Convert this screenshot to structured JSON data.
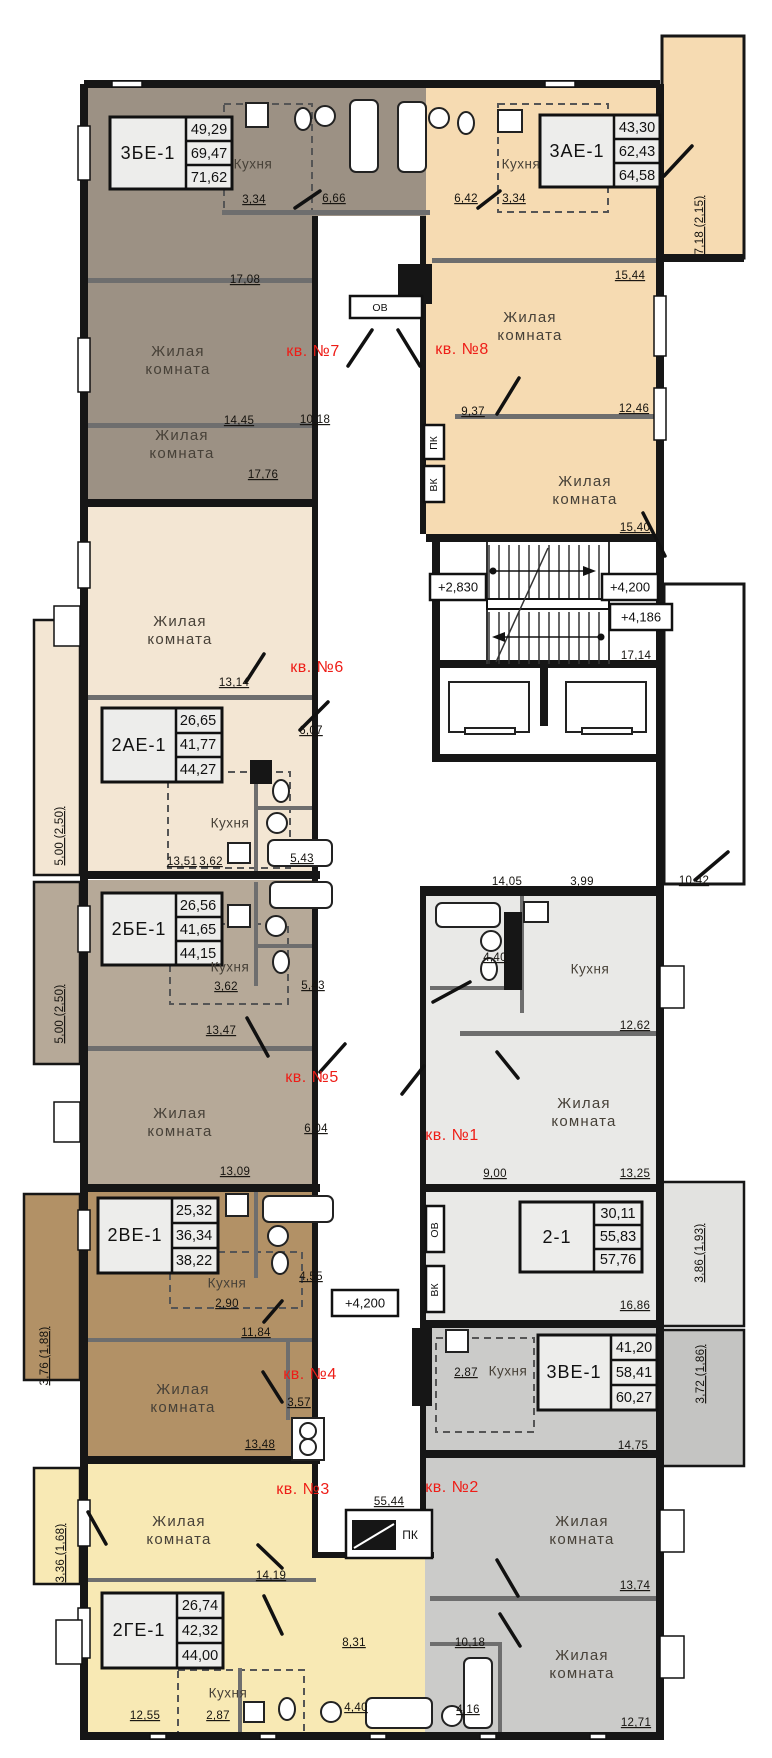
{
  "labels": {
    "living1": "Жилая",
    "living2": "комната",
    "kitchen": "Кухня",
    "ov": "ОВ",
    "pk": "ПК",
    "vk": "ВК"
  },
  "apartments": [
    {
      "flat": "кв. №1",
      "unit": "2-1",
      "areas": [
        "30,11",
        "55,83",
        "57,76"
      ]
    },
    {
      "flat": "кв. №2",
      "unit": "3ВЕ-1",
      "areas": [
        "41,20",
        "58,41",
        "60,27"
      ]
    },
    {
      "flat": "кв. №3",
      "unit": "2ГЕ-1",
      "areas": [
        "26,74",
        "42,32",
        "44,00"
      ]
    },
    {
      "flat": "кв. №4",
      "unit": "2ВЕ-1",
      "areas": [
        "25,32",
        "36,34",
        "38,22"
      ]
    },
    {
      "flat": "кв. №5",
      "unit": "2БЕ-1",
      "areas": [
        "26,56",
        "41,65",
        "44,15"
      ]
    },
    {
      "flat": "кв. №6",
      "unit": "2АЕ-1",
      "areas": [
        "26,65",
        "41,77",
        "44,27"
      ]
    },
    {
      "flat": "кв. №7",
      "unit": "3БЕ-1",
      "areas": [
        "49,29",
        "69,47",
        "71,62"
      ]
    },
    {
      "flat": "кв. №8",
      "unit": "3АЕ-1",
      "areas": [
        "43,30",
        "62,43",
        "64,58"
      ]
    }
  ],
  "elevations": {
    "stair_low": "+2,830",
    "stair_high": "+4,200",
    "corridor": "+4,200",
    "entrance": "+4,186"
  },
  "dims": {
    "a7_hall": "17,08",
    "a7_k": "3,34",
    "a7_bath": "6,66",
    "a7_r1a": "14,45",
    "a7_r1b": "10,18",
    "a7_r2": "17,76",
    "a8_hall": "6,42",
    "a8_k": "3,34",
    "a8_top": "15,44",
    "a8_r1a": "9,37",
    "a8_r1b": "12,46",
    "a8_r2": "15,40",
    "a8_balc": "7,18 (2,15)",
    "a6_r1": "13,14",
    "a6_hall": "6,07",
    "a6_ka": "13,51",
    "a6_kb": "3,62",
    "a6_bath": "5,43",
    "a6_balc": "5,00 (2,50)",
    "a5_kb": "3,62",
    "a5_bath": "5,43",
    "a5_k": "13,47",
    "a5_hall": "6,04",
    "a5_r2": "13,09",
    "a5_balc": "5,00 (2,50)",
    "a4_bath": "4,55",
    "a4_k": "2,90",
    "a4_hall": "11,84",
    "a4_c": "3,57",
    "a4_r1": "13,48",
    "a4_balc": "3,76 (1,88)",
    "a3_r1": "14,19",
    "a3_k1": "12,55",
    "a3_k2": "2,87",
    "a3_hall": "8,31",
    "a3_bath": "4,40",
    "a3_balc": "3,36 (1,68)",
    "a1_bath": "4,40",
    "a1_k": "12,62",
    "a1_r1a": "9,00",
    "a1_r1b": "13,25",
    "a1_r2": "16,86",
    "a1_balc": "3,86 (1,93)",
    "a2_k": "2,87",
    "a2_ktop": "14,75",
    "a2_r1": "13,74",
    "a2_hall": "10,18",
    "a2_r2": "12,71",
    "a2_bath": "4,16",
    "a2_balc": "3,72 (1,86)",
    "cor_a": "14,05",
    "cor_b": "3,99",
    "cor_c": "10,42",
    "stair": "17,14",
    "pk_box": "55,44"
  }
}
